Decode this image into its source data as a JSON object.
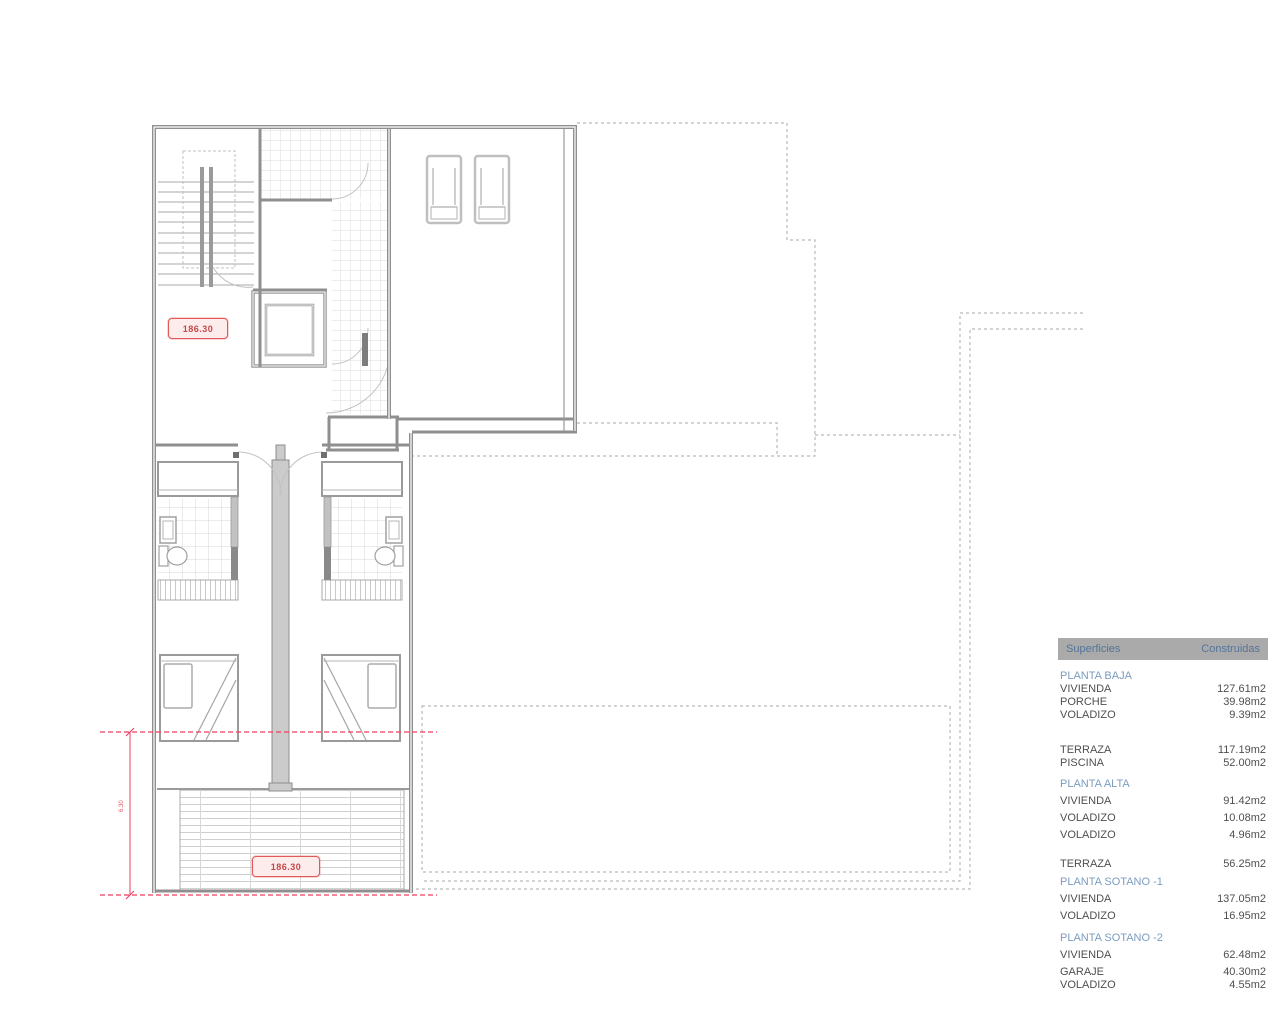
{
  "plan": {
    "level_label_upper": "186.30",
    "level_label_terrace": "186.30",
    "dimension_label": "6.30"
  },
  "table": {
    "header": {
      "left": "Superficies",
      "right": "Construidas"
    },
    "rows": [
      {
        "type": "section",
        "label": "PLANTA BAJA"
      },
      {
        "type": "item",
        "label": "VIVIENDA",
        "value": "127.61m2"
      },
      {
        "type": "item",
        "label": "PORCHE",
        "value": "39.98m2"
      },
      {
        "type": "item",
        "label": "VOLADIZO",
        "value": "9.39m2"
      },
      {
        "type": "item",
        "label": "TERRAZA",
        "value": "117.19m2"
      },
      {
        "type": "item",
        "label": "PISCINA",
        "value": "52.00m2"
      },
      {
        "type": "section",
        "label": "PLANTA ALTA"
      },
      {
        "type": "item",
        "label": "VIVIENDA",
        "value": "91.42m2"
      },
      {
        "type": "item",
        "label": "VOLADIZO",
        "value": "10.08m2"
      },
      {
        "type": "item",
        "label": "VOLADIZO",
        "value": "4.96m2"
      },
      {
        "type": "item",
        "label": "TERRAZA",
        "value": "56.25m2"
      },
      {
        "type": "section",
        "label": "PLANTA SOTANO -1"
      },
      {
        "type": "item",
        "label": "VIVIENDA",
        "value": "137.05m2"
      },
      {
        "type": "item",
        "label": "VOLADIZO",
        "value": "16.95m2"
      },
      {
        "type": "section",
        "label": "PLANTA SOTANO -2"
      },
      {
        "type": "item",
        "label": "VIVIENDA",
        "value": "62.48m2"
      },
      {
        "type": "item",
        "label": "GARAJE",
        "value": "40.30m2"
      },
      {
        "type": "item",
        "label": "VOLADIZO",
        "value": "4.55m2"
      }
    ]
  },
  "colors": {
    "wall_gray": "#8f8f8f",
    "projection_dash_gray": "#b9b9b9",
    "dimension_red": "#ee3d60",
    "label_red_border": "#e05858",
    "table_header_bg": "#aaaaaa",
    "table_header_text": "#54759a",
    "section_blue": "#7b9cbe",
    "body_text": "#4f4f4f"
  }
}
